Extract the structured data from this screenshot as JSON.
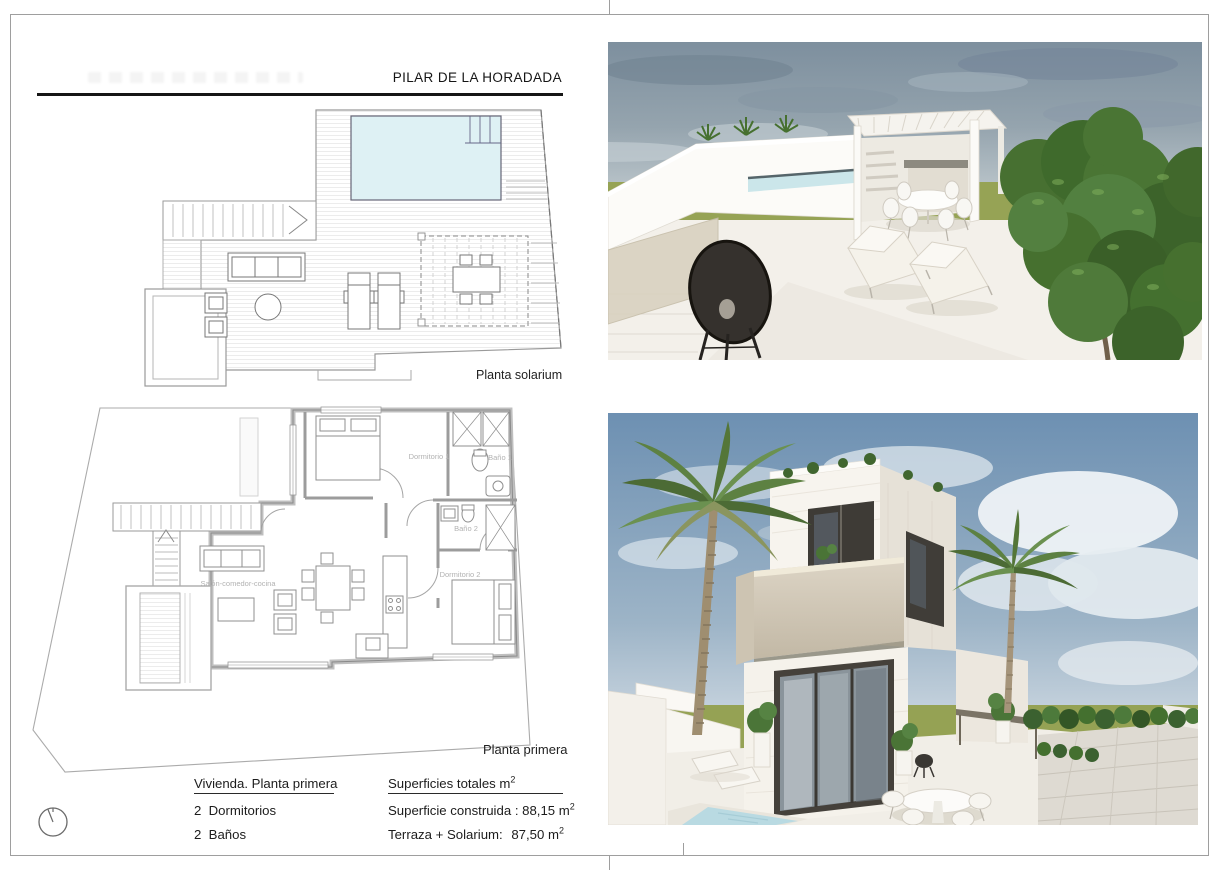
{
  "sheet": {
    "title": "PILAR DE LA HORADADA"
  },
  "solarium_plan": {
    "caption": "Planta solarium",
    "features": [
      "pool",
      "stairs",
      "sofa",
      "round-table",
      "armchairs",
      "sun-loungers",
      "pergola",
      "dining-table"
    ]
  },
  "primera_plan": {
    "caption": "Planta primera",
    "rooms": {
      "dormitorio1": "Dormitorio 1",
      "bano1": "Baño 1",
      "bano2": "Baño 2",
      "dormitorio2": "Dormitorio 2",
      "salon": "Salón-comedor-cocina"
    }
  },
  "summary": {
    "vivienda": {
      "title": "Vivienda. Planta primera",
      "bedrooms": "2  Dormitorios",
      "bathrooms": "2  Baños"
    },
    "superficies": {
      "title": "Superficies totales m",
      "title_sup": "2",
      "construida": "Superficie construida : 88,15 m",
      "construida_sup": "2",
      "terraza_label": "Terraza + Solarium:",
      "terraza_value": "87,50 m",
      "terraza_sup": "2"
    }
  },
  "icons": {
    "north_arrow": "compass-circle-with-needle"
  },
  "colors": {
    "pool_plan": "#def1f4",
    "wall_gray": "#bfbfbf",
    "sheet_border": "#9e9e9e",
    "grass": "#96a355",
    "sky_terrace": "#8295a4",
    "sky_villa": "#6f92b4",
    "tree_green": "#46702f",
    "stone_beige": "#d5cdbc",
    "photo_floor": "#f3f0ea",
    "glass_dark": "#45413b"
  }
}
